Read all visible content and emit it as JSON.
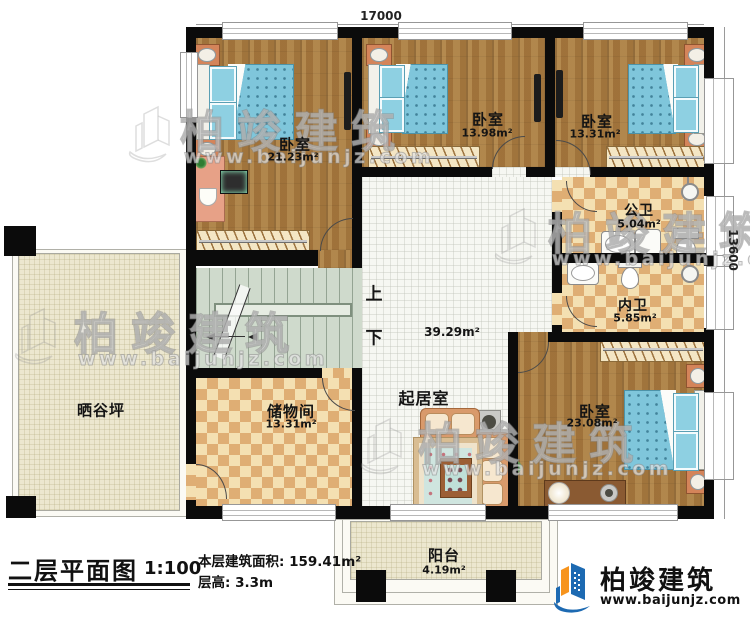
{
  "dimensions": {
    "width_mm": "17000",
    "height_mm": "13600"
  },
  "rooms": {
    "bedroom_tl": {
      "label": "卧室",
      "area": "21.23m²"
    },
    "bedroom_tc": {
      "label": "卧室",
      "area": "13.98m²"
    },
    "bedroom_tr": {
      "label": "卧室",
      "area": "13.31m²"
    },
    "public_bath": {
      "label": "公卫",
      "area": "5.04m²"
    },
    "inner_bath": {
      "label": "内卫",
      "area": "5.85m²"
    },
    "bedroom_br": {
      "label": "卧室",
      "area": "23.08m²"
    },
    "living": {
      "label": "起居室",
      "area": "39.29m²"
    },
    "storage": {
      "label": "储物间",
      "area": "13.31m²"
    },
    "drying_yard": {
      "label": "晒谷坪"
    },
    "balcony": {
      "label": "阳台",
      "area": "4.19m²"
    }
  },
  "stairs": {
    "up_label": "上",
    "down_label": "下"
  },
  "titleblock": {
    "title": "二层平面图",
    "scale": "1:100",
    "floor_area_label": "本层建筑面积:",
    "floor_area_value": "159.41m²",
    "floor_height_label": "层高:",
    "floor_height_value": "3.3m"
  },
  "brand": {
    "name": "柏竣建筑",
    "website": "www.baijunjz.com",
    "logo_blue": "#1d6ab2",
    "logo_orange": "#f7941d"
  },
  "watermark": {
    "name": "柏竣建筑",
    "website": "www.baijunjz.com"
  }
}
